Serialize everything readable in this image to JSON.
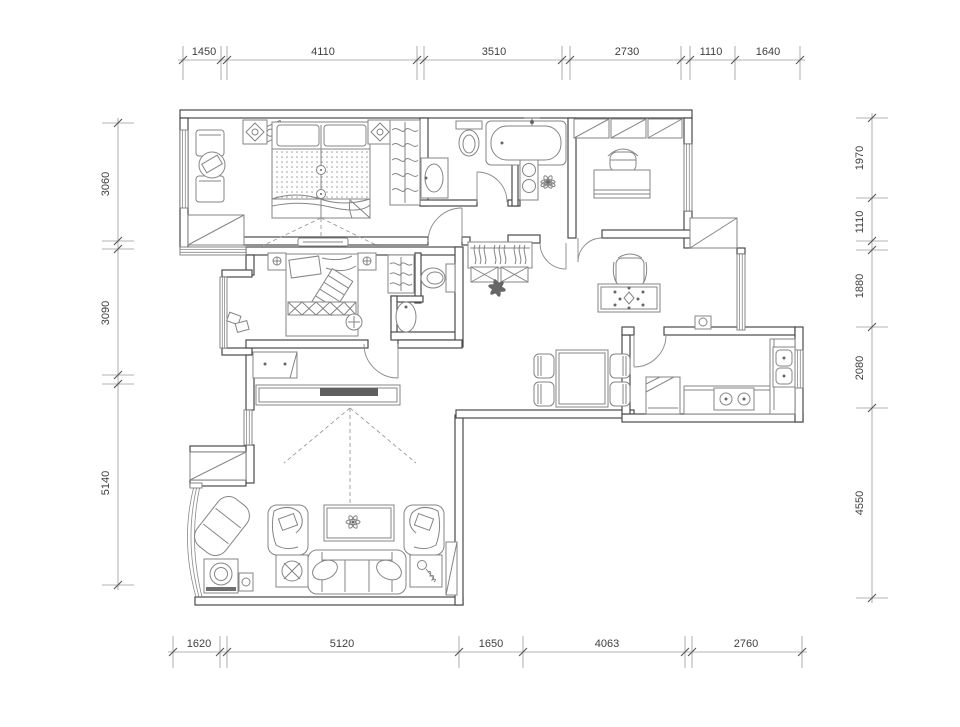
{
  "drawing": {
    "type": "apartment-floor-plan",
    "units": "mm",
    "dimensions": {
      "top": [
        "1450",
        "4110",
        "3510",
        "2730",
        "1110",
        "1640"
      ],
      "bottom": [
        "1620",
        "5120",
        "1650",
        "4063",
        "2760"
      ],
      "left": [
        "3060",
        "3090",
        "5140"
      ],
      "right": [
        "1970",
        "1110",
        "1880",
        "2080",
        "4550"
      ]
    },
    "colors": {
      "wall_line": "#4a4a4a",
      "furniture_line": "#858585",
      "dimension_line": "#9a9a9a",
      "text": "#3f3f3f",
      "background": "#ffffff"
    }
  }
}
